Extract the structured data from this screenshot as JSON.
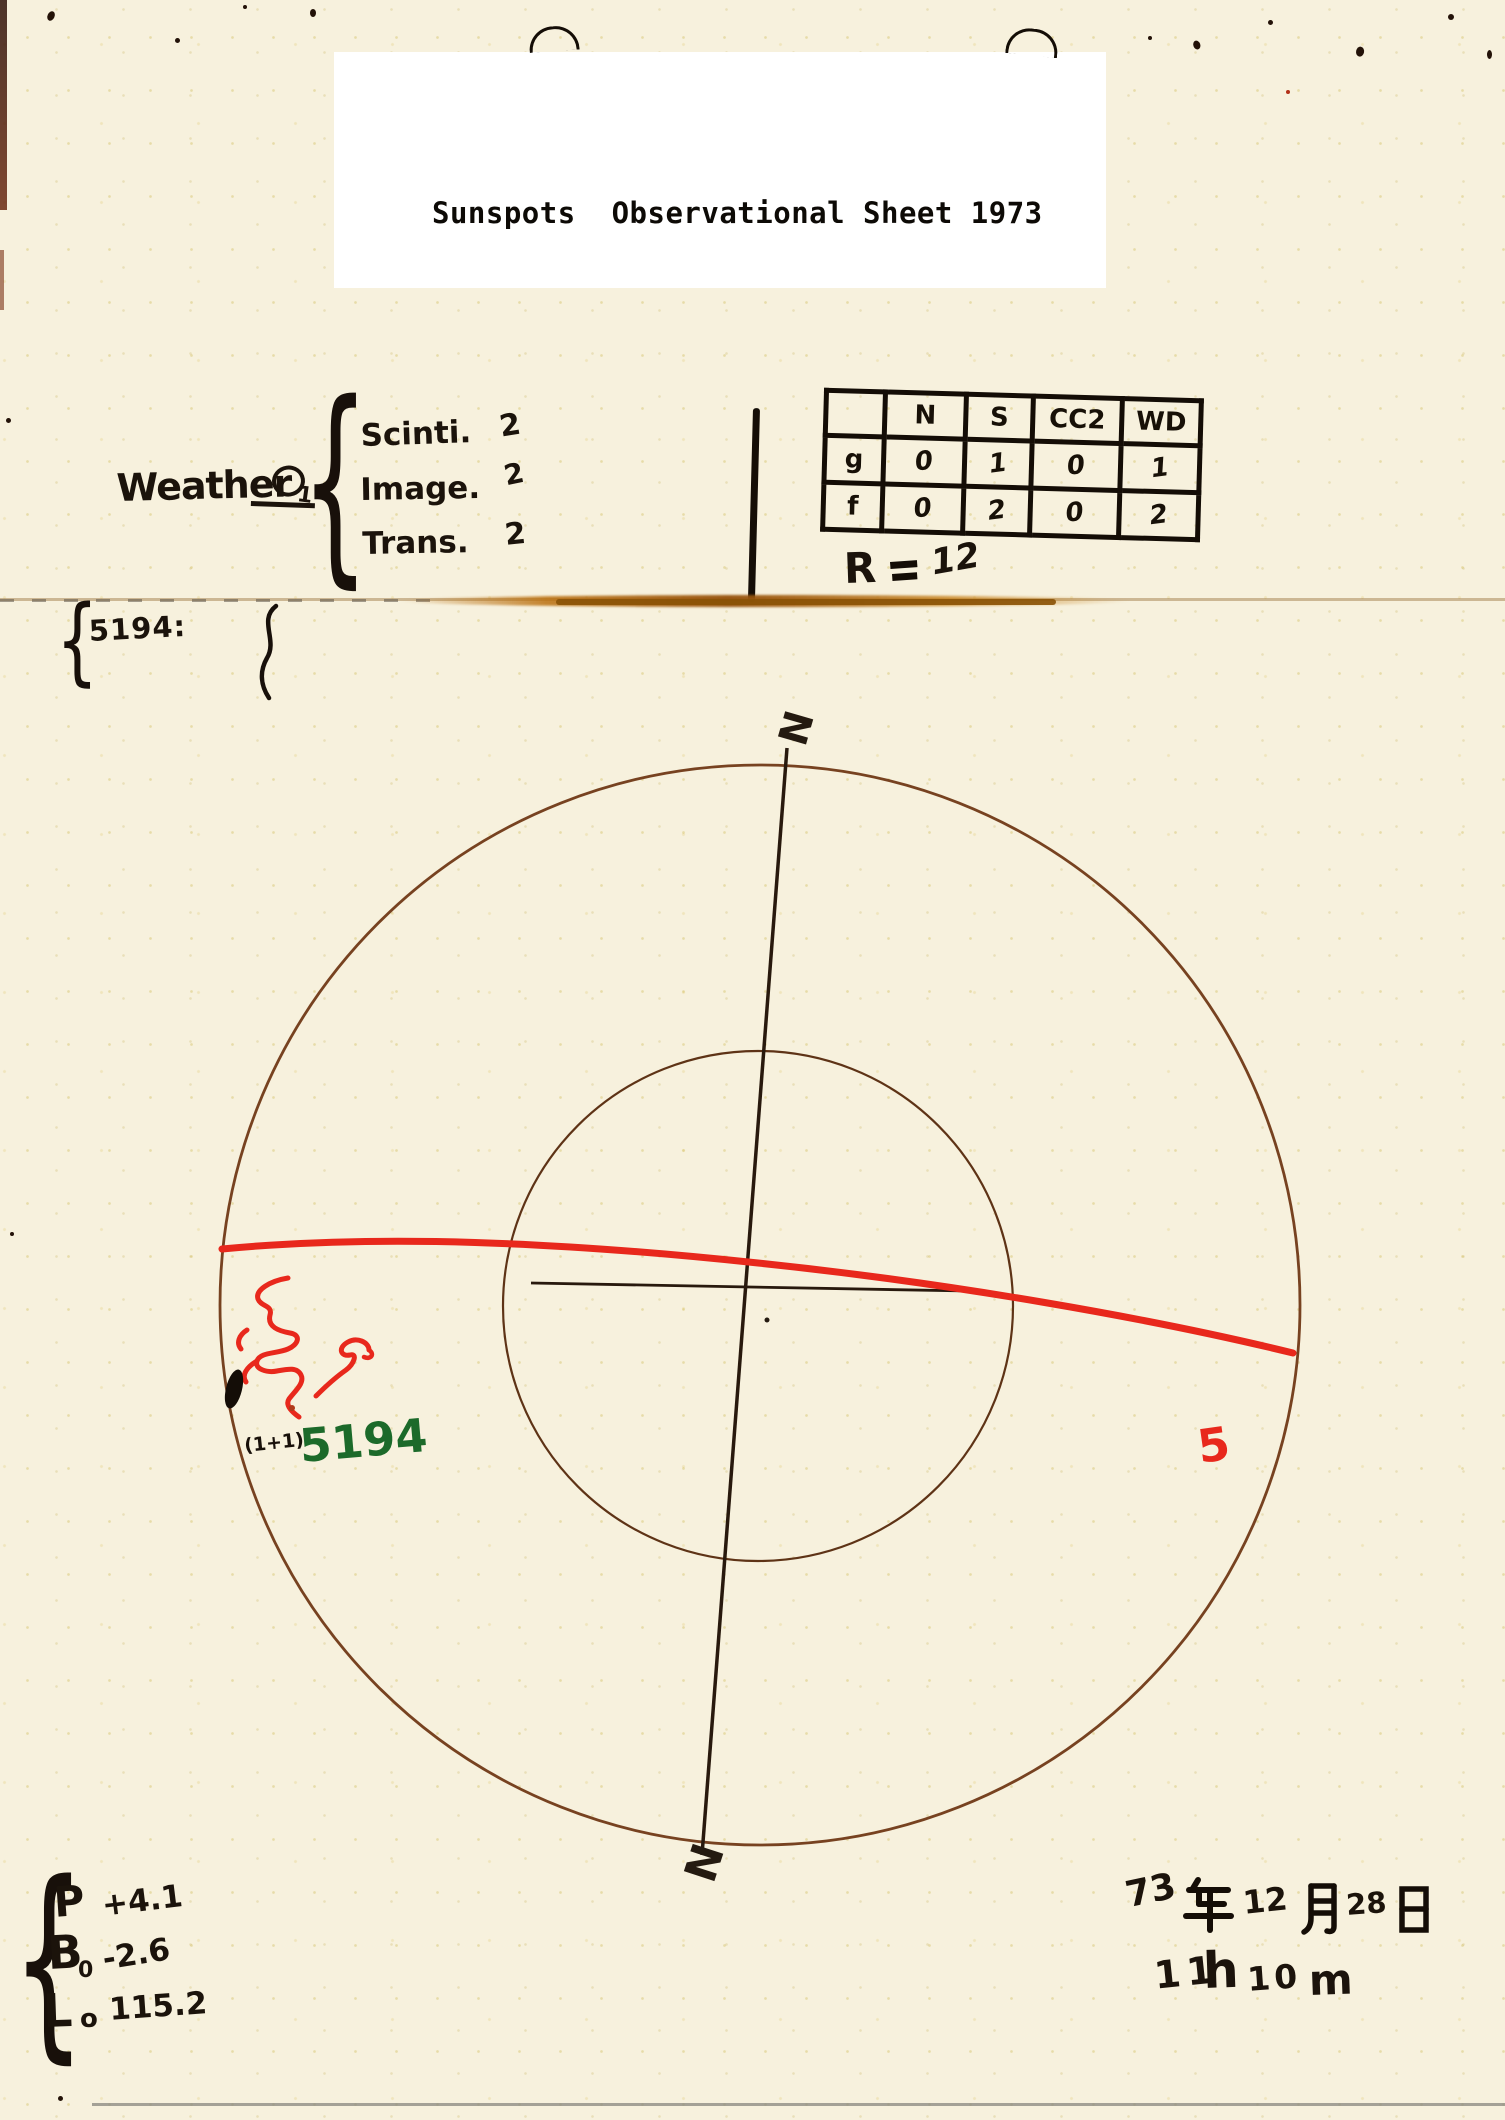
{
  "title_panel": {
    "title": "Sunspots  Observational Sheet 1973"
  },
  "symbols": {
    "brace": "{"
  },
  "weather": {
    "label": "Weather",
    "mark": "O",
    "subscript": "1",
    "items": [
      {
        "label": "Scinti.",
        "value": "2"
      },
      {
        "label": "Image.",
        "value": "2"
      },
      {
        "label": "Trans.",
        "value": "2"
      }
    ]
  },
  "count_table": {
    "columns": [
      "",
      "N",
      "S",
      "CC2",
      "WD"
    ],
    "rows": [
      {
        "label": "g",
        "values": [
          "0",
          "1",
          "0",
          "1"
        ]
      },
      {
        "label": "f",
        "values": [
          "0",
          "2",
          "0",
          "2"
        ]
      }
    ]
  },
  "relative_number": {
    "label": "R",
    "value": "12"
  },
  "margin_note": {
    "text": "5194:"
  },
  "disk": {
    "north_label": "N",
    "south_label": "N",
    "group_count": "(1+1)",
    "group_number": "5194",
    "south_mark": "5"
  },
  "ephemeris": {
    "p_label": "P",
    "p_value": "+4.1",
    "b_label": "B",
    "b_sub": "0",
    "b_value": "-2.6",
    "l_label": "L",
    "l_sub": "o",
    "l_value": "115.2"
  },
  "datetime": {
    "year": "73",
    "year_unit": "年",
    "month": "12",
    "month_unit": "月",
    "day": "28",
    "day_unit": "日",
    "hour": "11",
    "hour_unit": "h",
    "minute": "10",
    "minute_unit": "m"
  },
  "colors": {
    "paper": "#f7f1dd",
    "panel": "#ffffff",
    "ink": "#1b130b",
    "circle_sepia": "#744019",
    "equator_red": "#e8281c",
    "group_green": "#1c6a2a",
    "crease_amber": "#b06a10"
  }
}
